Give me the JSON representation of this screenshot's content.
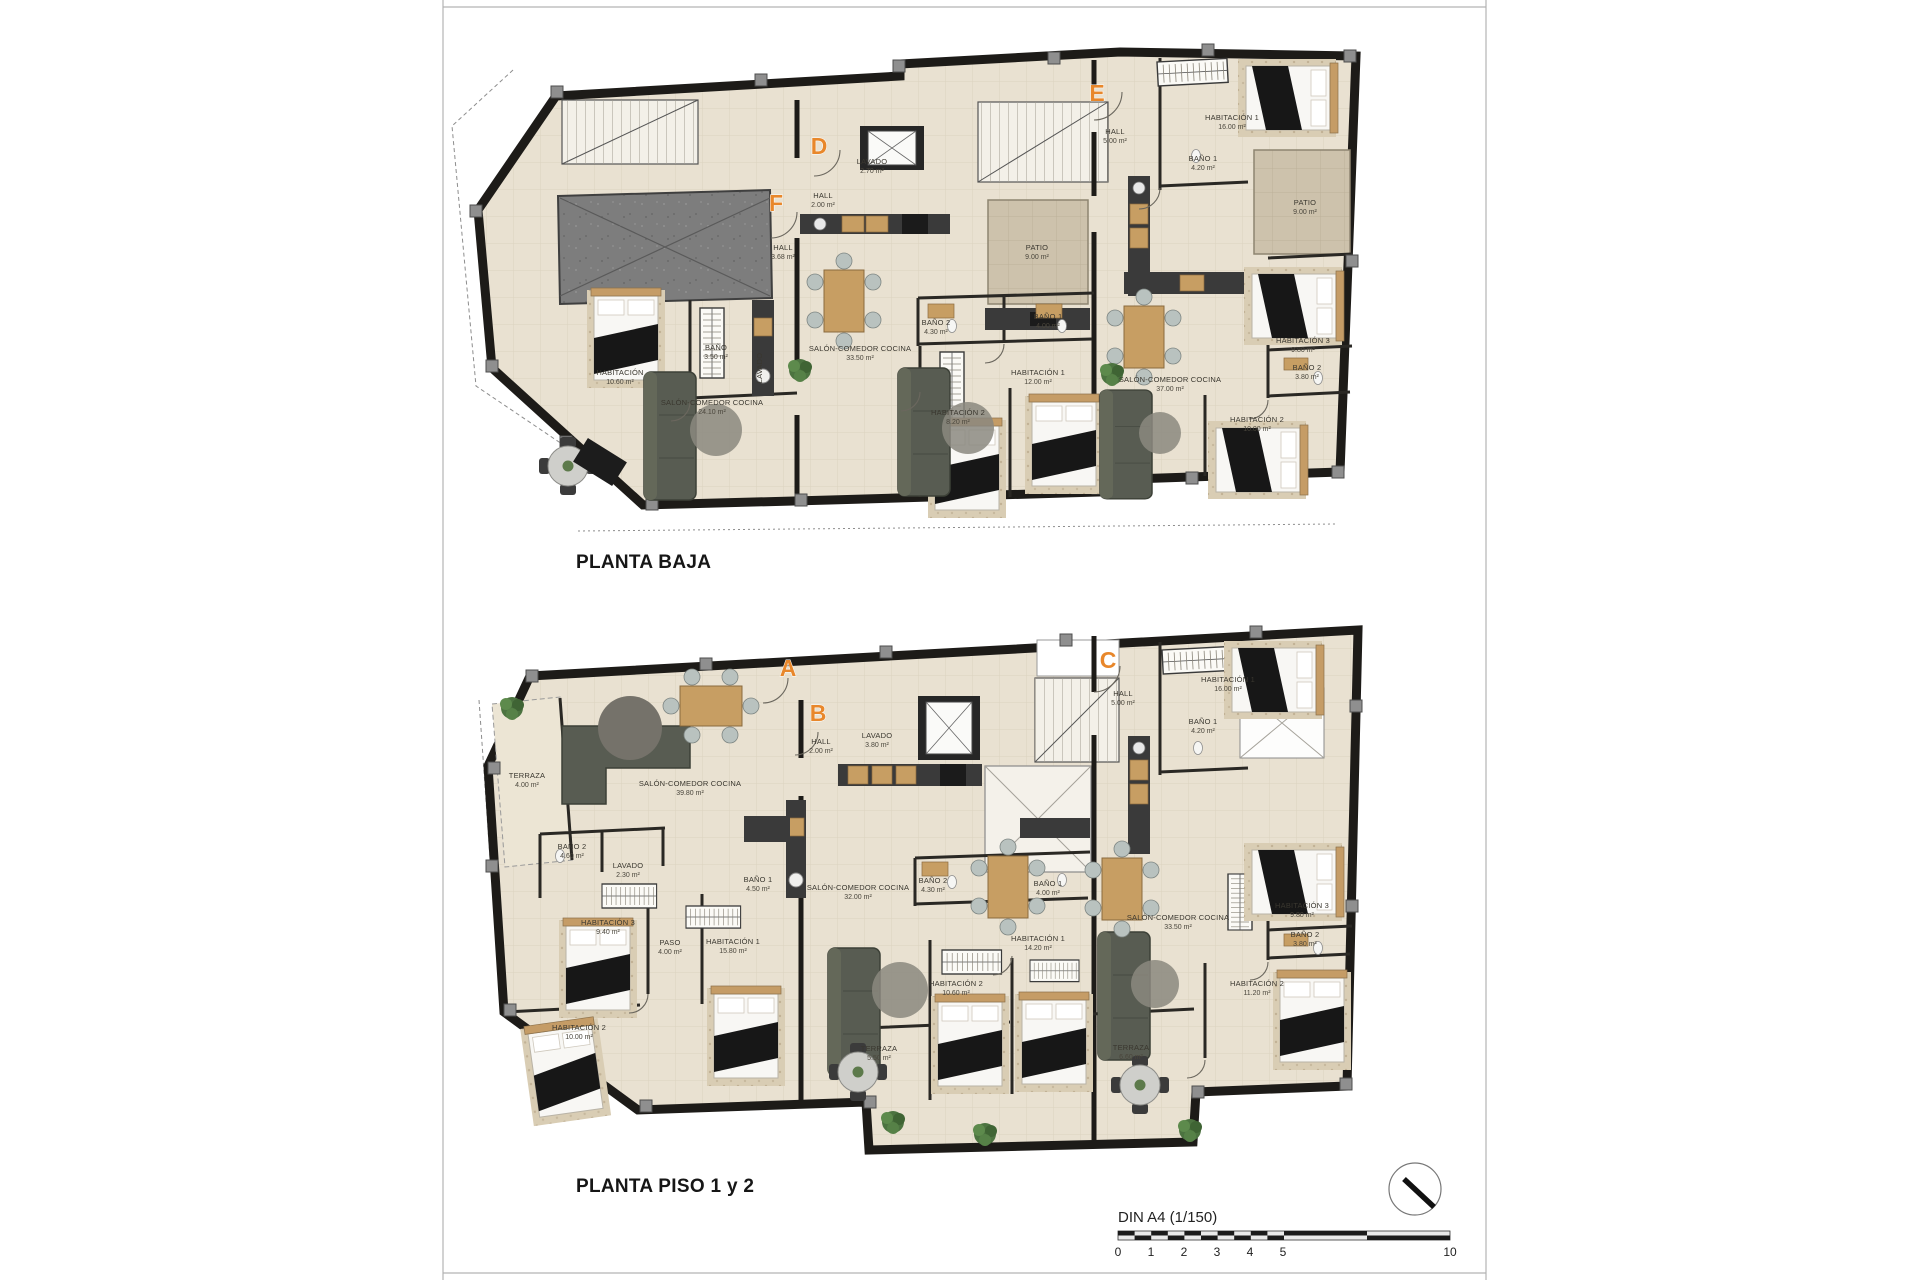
{
  "sheet": {
    "scale_label": "DIN A4 (1/150)",
    "scale_ticks": [
      "0",
      "1",
      "2",
      "3",
      "4",
      "5",
      "10"
    ],
    "icons": {
      "north": "north-arrow-icon"
    },
    "palette": {
      "accent_orange": "#E8872B",
      "wall_black": "#1D1B18",
      "floor_beige": "#E9E1D1",
      "patio_tan": "#CDC2AC",
      "garage_gray": "#7D7D7D",
      "wood": "#C79E63",
      "sofa_green_gray": "#585C52"
    }
  },
  "plans": [
    {
      "title": "PLANTA BAJA",
      "units": [
        {
          "marker": "F",
          "rooms": [
            {
              "name": "HALL",
              "area": "3.68 m²"
            },
            {
              "name": "BAÑO",
              "area": "3.50 m²"
            },
            {
              "name": "LAVADO",
              "area": ""
            },
            {
              "name": "HABITACIÓN",
              "area": "10.60 m²"
            },
            {
              "name": "SALÓN-COMEDOR COCINA",
              "area": "24.10 m²"
            }
          ]
        },
        {
          "marker": "D",
          "rooms": [
            {
              "name": "LAVADO",
              "area": "2.70 m²"
            },
            {
              "name": "HALL",
              "area": "2.00 m²"
            },
            {
              "name": "PATIO",
              "area": "9.00 m²"
            },
            {
              "name": "SALÓN-COMEDOR COCINA",
              "area": "33.50 m²"
            },
            {
              "name": "BAÑO 2",
              "area": "4.30 m²"
            },
            {
              "name": "BAÑO 1",
              "area": "4.00 m²"
            },
            {
              "name": "HABITACIÓN 1",
              "area": "12.00 m²"
            },
            {
              "name": "HABITACIÓN 2",
              "area": "8.20 m²"
            }
          ]
        },
        {
          "marker": "E",
          "rooms": [
            {
              "name": "HALL",
              "area": "5.00 m²"
            },
            {
              "name": "HABITACIÓN 1",
              "area": "16.00 m²"
            },
            {
              "name": "BAÑO 1",
              "area": "4.20 m²"
            },
            {
              "name": "PATIO",
              "area": "9.00 m²"
            },
            {
              "name": "SALÓN-COMEDOR COCINA",
              "area": "37.00 m²"
            },
            {
              "name": "HABITACIÓN 3",
              "area": "9.80 m²"
            },
            {
              "name": "BAÑO 2",
              "area": "3.80 m²"
            },
            {
              "name": "HABITACIÓN 2",
              "area": "10.00 m²"
            }
          ]
        }
      ]
    },
    {
      "title": "PLANTA PISO 1 y 2",
      "units": [
        {
          "marker": "A",
          "rooms": [
            {
              "name": "TERRAZA",
              "area": "4.00 m²"
            },
            {
              "name": "SALÓN-COMEDOR COCINA",
              "area": "39.80 m²"
            },
            {
              "name": "BAÑO 2",
              "area": "4.60 m²"
            },
            {
              "name": "LAVADO",
              "area": "2.30 m²"
            },
            {
              "name": "BAÑO 1",
              "area": "4.50 m²"
            },
            {
              "name": "HABITACIÓN 3",
              "area": "9.40 m²"
            },
            {
              "name": "PASO",
              "area": "4.00 m²"
            },
            {
              "name": "HABITACIÓN 1",
              "area": "15.80 m²"
            },
            {
              "name": "HABITACIÓN 2",
              "area": "10.00 m²"
            }
          ]
        },
        {
          "marker": "B",
          "rooms": [
            {
              "name": "HALL",
              "area": "2.00 m²"
            },
            {
              "name": "LAVADO",
              "area": "3.80 m²"
            },
            {
              "name": "SALÓN-COMEDOR COCINA",
              "area": "32.00 m²"
            },
            {
              "name": "BAÑO 2",
              "area": "4.30 m²"
            },
            {
              "name": "BAÑO 1",
              "area": "4.00 m²"
            },
            {
              "name": "HABITACIÓN 1",
              "area": "14.20 m²"
            },
            {
              "name": "HABITACIÓN 2",
              "area": "10.60 m²"
            },
            {
              "name": "TERRAZA",
              "area": "5.50 m²"
            }
          ]
        },
        {
          "marker": "C",
          "rooms": [
            {
              "name": "HALL",
              "area": "5.00 m²"
            },
            {
              "name": "HABITACIÓN 1",
              "area": "16.00 m²"
            },
            {
              "name": "BAÑO 1",
              "area": "4.20 m²"
            },
            {
              "name": "SALÓN-COMEDOR COCINA",
              "area": "33.50 m²"
            },
            {
              "name": "HABITACIÓN 3",
              "area": "9.80 m²"
            },
            {
              "name": "BAÑO 2",
              "area": "3.80 m²"
            },
            {
              "name": "HABITACIÓN 2",
              "area": "11.20 m²"
            },
            {
              "name": "TERRAZA",
              "area": "6.60 m²"
            }
          ]
        }
      ]
    }
  ]
}
